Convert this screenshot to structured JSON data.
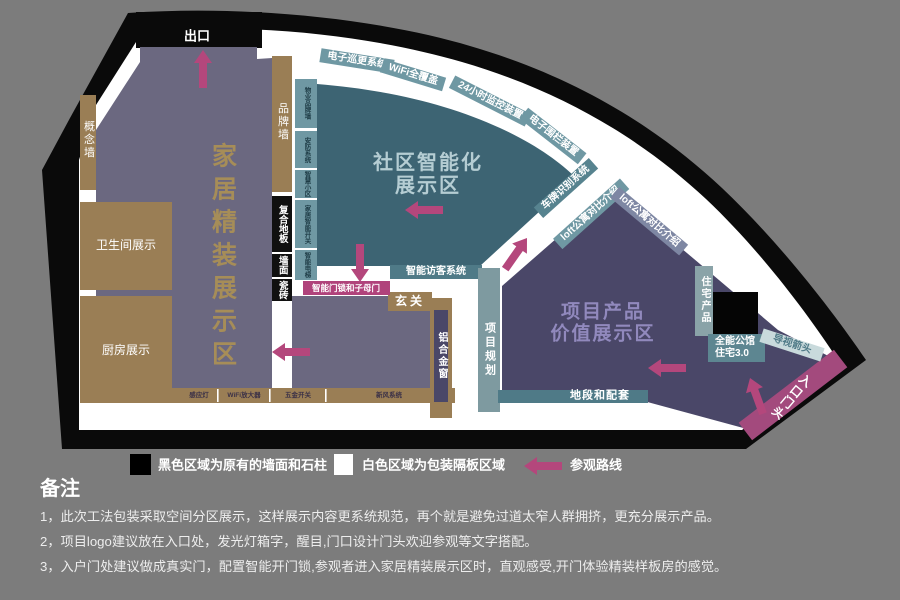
{
  "colors": {
    "background": "#7c7c7c",
    "wall_black": "#0a0a0a",
    "partition_white": "#ffffff",
    "home_zone_purple": "#6b6880",
    "tan": "#9a7e55",
    "community_teal": "#3d6473",
    "teal_strip_light": "#6f98a3",
    "teal_band": "#4f7a87",
    "project_dark_purple": "#4a4768",
    "loft_strip_blue": "#7e87a3",
    "pink_strip": "#b0437b",
    "entrance_magenta": "#a34a7d",
    "route_arrow_pink": "#b4477c",
    "home_title_gold": "#a68d58",
    "community_title": "#b5cdd3",
    "project_title": "#9189bd"
  },
  "plan": {
    "exit": "出口",
    "zone_home": "家居精装展示区",
    "zone_community_l1": "社区智能化",
    "zone_community_l2": "展示区",
    "zone_project_l1": "项目产品",
    "zone_project_l2": "价值展示区",
    "concept_wall": "概念墙",
    "brand_wall": "品牌墙",
    "bathroom": "卫生间展示",
    "kitchen": "厨房展示",
    "floor_strip": [
      "复合地板",
      "墙面",
      "瓷砖"
    ],
    "bottom_strip": [
      "感应灯",
      "WiFi放大器",
      "五金开关",
      "新风系统"
    ],
    "teal_left_strips": [
      "物业品牌墙",
      "安防系统",
      "智慧小区",
      "家居智能开关",
      "智能电梯"
    ],
    "arc_strips": [
      "电子巡更系统",
      "WiFi全覆盖",
      "24小时监控装置",
      "电子围栏装置",
      "车牌识别系统",
      "loft公寓对比介绍",
      "loft公寓对比介绍"
    ],
    "visitor_system": "智能访客系统",
    "door_lock": "智能门锁和子母门",
    "hallway": "玄关",
    "aluminum_window": "铝合金窗",
    "project_planning": "项目规划",
    "location_support": "地段和配套",
    "residential_product": "住宅产品",
    "mansion_l1": "全能公馆",
    "mansion_l2": "住宅3.0",
    "guide_arrow": "导视箭头",
    "entrance": "入口门头"
  },
  "legend": {
    "black": "黑色区域为原有的墙面和石柱",
    "white": "白色区域为包装隔板区域",
    "route": "参观路线"
  },
  "notes": {
    "title": "备注",
    "items": [
      "1，此次工法包装采取空间分区展示，这样展示内容更系统规范，再个就是避免过道太窄人群拥挤，更充分展示产品。",
      "2，项目logo建议放在入口处，发光灯箱字，醒目,门口设计门头欢迎参观等文字搭配。",
      "3，入户门处建议做成真实门，配置智能开门锁,参观者进入家居精装展示区时，直观感受,开门体验精装样板房的感觉。"
    ]
  }
}
